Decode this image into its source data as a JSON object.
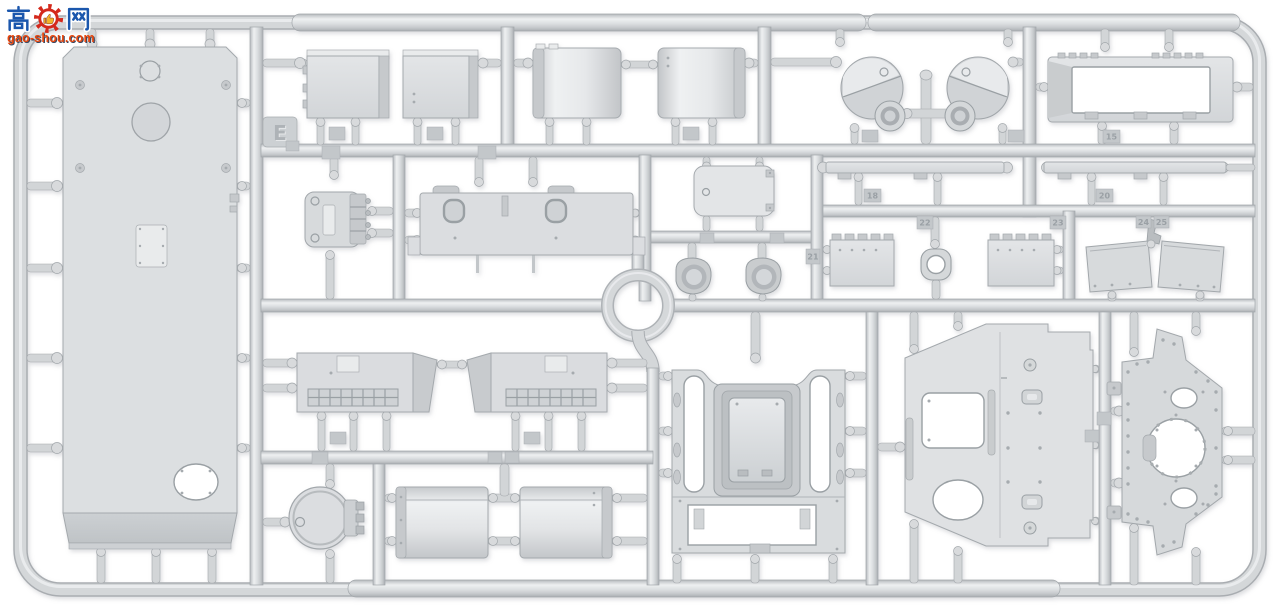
{
  "meta": {
    "type": "product-photo",
    "subject": "Injection-moulded model kit sprue of light grey styrene with armoured-vehicle hull and detail parts, photographed on a white background"
  },
  "watermark": {
    "text_cn": "高手网",
    "char_left": "高",
    "char_right": "网",
    "gear_icon": "gear-thumb-icon",
    "url": "gao-shou.com",
    "colors": {
      "blue": "#1b57ad",
      "red": "#d4291c",
      "yellow": "#f2b32a",
      "url_text": "#e8470e",
      "url_shadow": "#39455f"
    }
  },
  "sprue": {
    "letter": "E",
    "material": "light grey styrene plastic",
    "tags": {
      "t15": "15",
      "t18": "18",
      "t20": "20",
      "t21": "21",
      "t22": "22",
      "t23": "23",
      "t24": "24",
      "t25": "25"
    },
    "colors": {
      "plastic": "#d6d9db",
      "plastic_light": "#eef0f1",
      "plastic_dark": "#b6babd",
      "outline": "#a2a7ab",
      "hole": "#ffffff",
      "background": "#ffffff"
    },
    "parts": [
      {
        "id": "hull-top-panel",
        "desc": "Large hull panel with round opening, access hatch and oval cut-out"
      },
      {
        "id": "stowage-box-left",
        "desc": "Rectangular stowage box"
      },
      {
        "id": "stowage-box-right",
        "desc": "Rectangular stowage box"
      },
      {
        "id": "curved-cover-left",
        "desc": "Curved cover shell"
      },
      {
        "id": "curved-cover-right",
        "desc": "Curved cover shell"
      },
      {
        "id": "round-cover-left",
        "desc": "Round housing cover with bolt detail"
      },
      {
        "id": "round-cover-right",
        "desc": "Round housing cover with bolt detail"
      },
      {
        "id": "hub-left",
        "desc": "Small round hub"
      },
      {
        "id": "hub-right",
        "desc": "Small round hub"
      },
      {
        "id": "open-frame",
        "desc": "Rectangular frame with open centre"
      },
      {
        "id": "hinge-bracket",
        "desc": "Small bracket with hinge comb"
      },
      {
        "id": "rear-deck-panel",
        "desc": "Wide panel with grommets and top clamps"
      },
      {
        "id": "small-hatch",
        "desc": "Rounded rectangular hatch"
      },
      {
        "id": "cup-left",
        "desc": "Round cup / collar part"
      },
      {
        "id": "cup-right",
        "desc": "Round cup / collar part"
      },
      {
        "id": "fender-strip-left",
        "desc": "Long flat strip"
      },
      {
        "id": "fender-strip-right",
        "desc": "Long flat strip"
      },
      {
        "id": "hinged-plate-left",
        "desc": "Small plate with hinge teeth"
      },
      {
        "id": "clamp-ring",
        "desc": "Ring clamp with round hole"
      },
      {
        "id": "hinged-plate-right",
        "desc": "Small plate with hinge teeth"
      },
      {
        "id": "mud-flap-left",
        "desc": "Angled flat flap"
      },
      {
        "id": "mud-flap-right",
        "desc": "Angled flat flap"
      },
      {
        "id": "side-skirt-left",
        "desc": "Side skirt with louvred grille"
      },
      {
        "id": "side-skirt-right",
        "desc": "Side skirt with louvred grille"
      },
      {
        "id": "rear-bulkhead",
        "desc": "Bulkhead frame with deep recessed tub and lower opening"
      },
      {
        "id": "side-plate",
        "desc": "Large side plate with square and oval openings"
      },
      {
        "id": "roof-plate",
        "desc": "Angled roof plate with turret-ring opening and rivets"
      },
      {
        "id": "round-hatch",
        "desc": "Circular hatch with hinge block"
      },
      {
        "id": "curved-shell-left",
        "desc": "Curved fender shell"
      },
      {
        "id": "curved-shell-right",
        "desc": "Curved fender shell"
      }
    ]
  }
}
